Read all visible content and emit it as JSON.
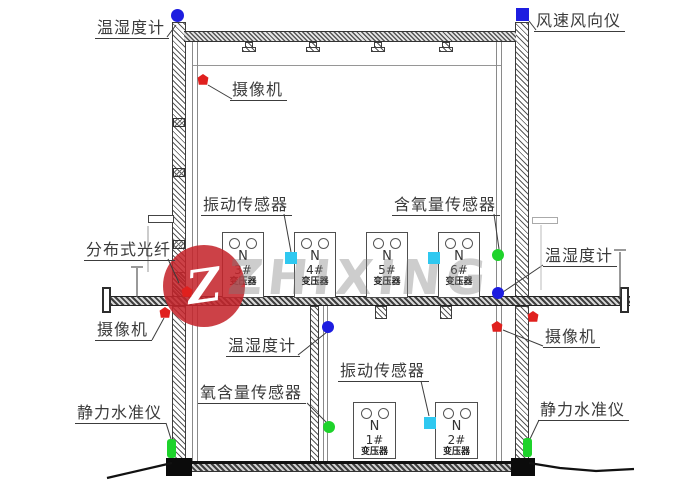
{
  "drawing": {
    "annotations": {
      "hygro_top_left": "温湿度计",
      "anemometer": "风速风向仪",
      "camera_upper": "摄像机",
      "vibration_upper": "振动传感器",
      "oxygen_upper": "含氧量传感器",
      "fiber": "分布式光纤",
      "hygro_right": "温湿度计",
      "camera_mid_left": "摄像机",
      "camera_mid_right": "摄像机",
      "hygro_lower": "温湿度计",
      "vibration_lower": "振动传感器",
      "oxygen_lower": "氧含量传感器",
      "level_left": "静力水准仪",
      "level_right": "静力水准仪"
    },
    "transformers": [
      {
        "phase": "N",
        "num": "3#",
        "type": "变压器"
      },
      {
        "phase": "N",
        "num": "4#",
        "type": "变压器"
      },
      {
        "phase": "N",
        "num": "5#",
        "type": "变压器"
      },
      {
        "phase": "N",
        "num": "6#",
        "type": "变压器"
      },
      {
        "phase": "N",
        "num": "1#",
        "type": "变压器"
      },
      {
        "phase": "N",
        "num": "2#",
        "type": "变压器"
      }
    ],
    "sensor_colors": {
      "temperature_humidity": "#1d1de0",
      "wind_instrument": "#1d1de0",
      "vibration": "#2fc8f0",
      "oxygen": "#1ed32b",
      "camera": "#e0201e",
      "static_level": "#1ed32b"
    },
    "line_color": "#3c3c3c"
  },
  "watermark": {
    "logo_letter": "Z",
    "brand": "ZHIXING",
    "circle_color": "#c4252c"
  }
}
